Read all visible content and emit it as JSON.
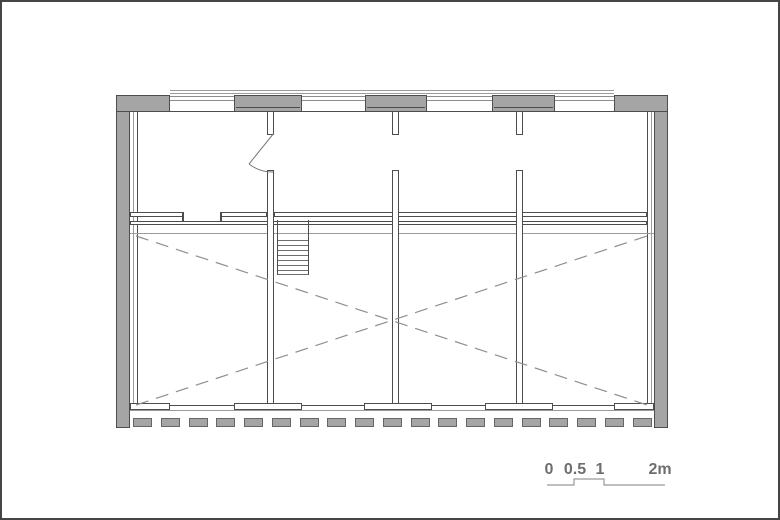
{
  "drawing": {
    "type": "architectural floor plan",
    "scale_bar": {
      "labels": [
        "0",
        "0.5",
        "1",
        "2m"
      ],
      "unit": "m"
    },
    "colors": {
      "wall_fill": "#a5a5a5",
      "wall_outline": "#4d4d4d",
      "thin_line": "#8c8c8c",
      "dashed_line": "#8f8f8f",
      "text": "#6e6e6e",
      "frame": "#454545",
      "background": "#ffffff"
    },
    "elements": {
      "window_piers_top": 3,
      "corner_blocks": 2,
      "interior_partitions": 3,
      "window_mullion_stubs": 3,
      "stair_treads": 7,
      "bottom_wall_dashes": 19,
      "bottom_wall_piers": 5,
      "void_marking": "dashed diagonal cross over double-height hall",
      "door_swing": "top-left room"
    }
  }
}
